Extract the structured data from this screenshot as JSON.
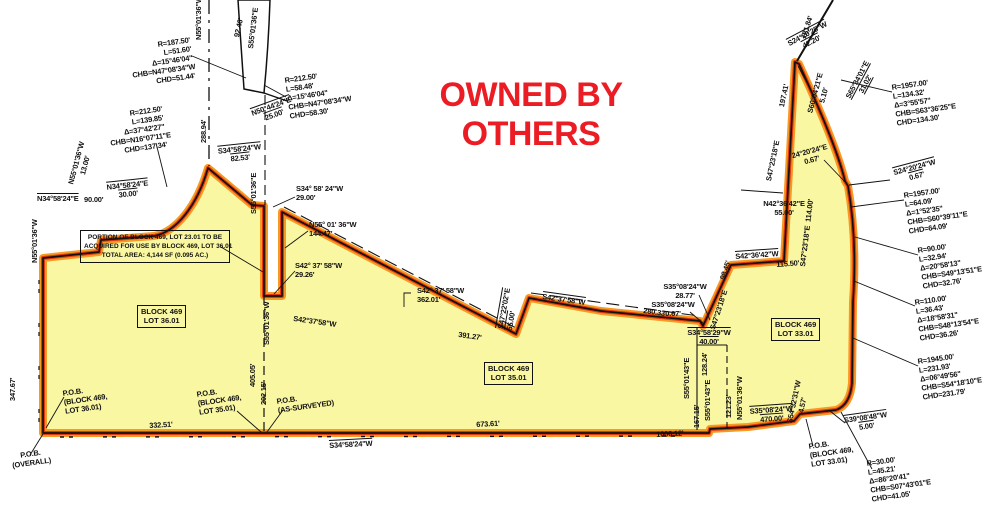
{
  "title": {
    "text": "OWNED BY OTHERS",
    "color": "#EC1C24",
    "x": 368,
    "y": 76,
    "w": 326
  },
  "colors": {
    "parcel_fill": "#FAF7A3",
    "boundary_glow": "#F59B23",
    "boundary_red": "#E23A0E",
    "line_black": "#111111"
  },
  "note_box": {
    "x": 80,
    "y": 230,
    "w": 142,
    "text": "PORTION OF BLOCK 469, LOT 23.01 TO BE\nACQUIRED FOR USE BY BLOCK 469, LOT 36.01\nTOTAL AREA: 4,144 SF (0.095 AC.)"
  },
  "lot_boxes": [
    {
      "n": "lot-label-36-01",
      "t": "BLOCK 469\nLOT 36.01",
      "x": 137,
      "y": 305
    },
    {
      "n": "lot-label-35-01",
      "t": "BLOCK 469\nLOT 35.01",
      "x": 484,
      "y": 362
    },
    {
      "n": "lot-label-33-01",
      "t": "BLOCK 469\nLOT 33.01",
      "x": 771,
      "y": 318
    }
  ],
  "labels": [
    {
      "n": "curve-data-1",
      "t": "R=187.50'\nL=51.60'\nΔ=15°46'04\"\nCHB=N47°08'34\"W\nCHD=51.44'",
      "x": 128,
      "y": 44,
      "r": -8,
      "c": "r",
      "w": 62
    },
    {
      "n": "curve-data-2",
      "t": "R=212.50'\nL=58.48'\nΔ=15°46'04\"\nCHB=N47°08'34\"W\nCHD=58.30'",
      "x": 284,
      "y": 76,
      "r": -8
    },
    {
      "n": "curve-data-3",
      "t": "R=212.50'\nL=139.85'\nΔ=37°42'27\"\nCHB=N16°07'11\"E\nCHD=137.34'",
      "x": 106,
      "y": 112,
      "r": -8,
      "c": "r",
      "w": 56
    },
    {
      "n": "curve-data-4",
      "t": "R=1957.00'\nL=134.32'\nΔ=3°55'57\"\nCHB=S63°36'25\"E\nCHD=134.30'",
      "x": 891,
      "y": 83,
      "r": -8
    },
    {
      "n": "curve-data-5",
      "t": "R=1957.00'\nL=64.09'\nΔ=1°52'35\"\nCHB=S60°39'11\"E\nCHD=64.09'",
      "x": 903,
      "y": 191,
      "r": -8
    },
    {
      "n": "curve-data-6",
      "t": "R=90.00'\nL=32.94'\nΔ=20°58'13\"\nCHB=S49°13'51\"E\nCHD=32.76'",
      "x": 917,
      "y": 246,
      "r": -8
    },
    {
      "n": "curve-data-7",
      "t": "R=110.00'\nL=36.43'\nΔ=18°58'31\"\nCHB=S48°13'54\"E\nCHD=36.26'",
      "x": 914,
      "y": 298,
      "r": -8
    },
    {
      "n": "curve-data-8",
      "t": "R=1945.00'\nL=231.93'\nΔ=06°49'56\"\nCHB=S54°18'10\"E\nCHD=231.79'",
      "x": 917,
      "y": 357,
      "r": -8
    },
    {
      "n": "curve-data-9",
      "t": "R=30.00'\nL=45.21'\nΔ=86°20'41\"\nCHB=S07°43'01\"E\nCHD=41.05'",
      "x": 866,
      "y": 459,
      "r": -8
    },
    {
      "t": "N50°44'24\"E\n25.00'",
      "x": 248,
      "y": 110,
      "r": -20,
      "c": "c ov",
      "w": 46
    },
    {
      "t": "S34°58'24\"W\n82.53'",
      "x": 215,
      "y": 147,
      "r": -6,
      "c": "c ov",
      "w": 48
    },
    {
      "t": "288.94'",
      "x": 199,
      "y": 143,
      "r": -90
    },
    {
      "t": "92.46'",
      "x": 232,
      "y": 36,
      "r": -77
    },
    {
      "t": "S55°01'36\"E",
      "x": 246,
      "y": 48,
      "r": -83
    },
    {
      "t": "N55°01'36\"W",
      "x": 194,
      "y": 40,
      "r": -90
    },
    {
      "t": "N55°01'36\"W\n13.00'",
      "x": 66,
      "y": 184,
      "r": -75,
      "c": "c",
      "w": 46
    },
    {
      "t": "N34°58'24\"E\n30.00'",
      "x": 104,
      "y": 183,
      "r": -6,
      "c": "c ov",
      "w": 46
    },
    {
      "t": "N34°58'24\"E",
      "x": 37,
      "y": 194,
      "c": "ov"
    },
    {
      "t": "90.00'",
      "x": 84,
      "y": 195
    },
    {
      "t": "N55°01'36\"W",
      "x": 30,
      "y": 263,
      "r": -90
    },
    {
      "t": "347.67'",
      "x": 8,
      "y": 401,
      "r": -90
    },
    {
      "t": "S55°01'36\"E",
      "x": 249,
      "y": 214,
      "r": -90
    },
    {
      "t": "S42°37'58\"W",
      "x": 294,
      "y": 314,
      "r": 8
    },
    {
      "t": "S42° 37' 58\"W\n362.01'",
      "x": 417,
      "y": 286
    },
    {
      "t": "391.27'",
      "x": 459,
      "y": 330,
      "r": 8
    },
    {
      "t": "S47°22'02\"E\n55.00'",
      "x": 496,
      "y": 328,
      "r": -80,
      "c": "ov"
    },
    {
      "t": "S42°37'58\"W",
      "x": 543,
      "y": 292,
      "r": 8,
      "c": "ov"
    },
    {
      "t": "280.33'",
      "x": 644,
      "y": 306,
      "r": 8
    },
    {
      "t": "S35°08'24\"W\n28.77'",
      "x": 662,
      "y": 282,
      "c": "c",
      "w": 46
    },
    {
      "t": "S35°08'24\"W\n0.67'",
      "x": 650,
      "y": 300,
      "c": "c",
      "w": 46
    },
    {
      "t": "98.45'",
      "x": 718,
      "y": 278,
      "r": -72
    },
    {
      "t": "S47°23'18\"E",
      "x": 708,
      "y": 328,
      "r": -72
    },
    {
      "t": "S42°36'42\"W",
      "x": 735,
      "y": 252,
      "r": -4,
      "c": "ov"
    },
    {
      "t": "115.50'",
      "x": 776,
      "y": 260,
      "r": -4
    },
    {
      "t": "N42°36'42\"E\n55.00'",
      "x": 763,
      "y": 199,
      "c": "c",
      "w": 42
    },
    {
      "t": "S47°23'18\"E  114.00'",
      "x": 798,
      "y": 266,
      "r": -83
    },
    {
      "t": "S47°23'18\"E",
      "x": 764,
      "y": 180,
      "r": -78
    },
    {
      "t": "24°20'24\"E\n0.67'",
      "x": 789,
      "y": 152,
      "r": -15,
      "c": "c",
      "w": 40
    },
    {
      "t": "S24°20'24\"W\n0.67'",
      "x": 890,
      "y": 169,
      "r": -15,
      "c": "c ov",
      "w": 48
    },
    {
      "t": "197.41'",
      "x": 777,
      "y": 106,
      "r": -78
    },
    {
      "t": "S60°04'21\"E\n5.10'",
      "x": 805,
      "y": 113,
      "r": -75,
      "c": "c",
      "w": 44
    },
    {
      "t": "S65°34'01\"E\n31.02'",
      "x": 843,
      "y": 97,
      "r": -62,
      "c": "c un",
      "w": 44
    },
    {
      "t": "S24°20'25\"W\n42.20'",
      "x": 784,
      "y": 41,
      "r": -28,
      "c": "c ov",
      "w": 48
    },
    {
      "t": "181.84'",
      "x": 799,
      "y": 37,
      "r": -72
    },
    {
      "t": "S39°08'48\"W\n5.00'",
      "x": 843,
      "y": 416,
      "r": -8,
      "c": "c ov",
      "w": 44
    },
    {
      "n": "pob-lot-33-01",
      "t": "P.O.B.\n(BLOCK 469,\nLOT 33.01)",
      "x": 808,
      "y": 442,
      "r": -8
    },
    {
      "t": "S54°32'31\"W\n4.57'",
      "x": 785,
      "y": 422,
      "r": -78,
      "c": "c",
      "w": 40
    },
    {
      "t": "S35°08'24\"W\n470.00'",
      "x": 748,
      "y": 407,
      "r": -4,
      "c": "c ov",
      "w": 46
    },
    {
      "t": "N55°01'36\"W",
      "x": 735,
      "y": 420,
      "r": -90
    },
    {
      "t": "121.23'",
      "x": 724,
      "y": 418,
      "r": -90
    },
    {
      "t": "S55°01'43\"E",
      "x": 682,
      "y": 399,
      "r": -90
    },
    {
      "t": "128.24'",
      "x": 700,
      "y": 376,
      "r": -90
    },
    {
      "t": "S55°01'43\"E",
      "x": 703,
      "y": 421,
      "r": -90
    },
    {
      "t": "167.15'",
      "x": 692,
      "y": 428,
      "r": -90
    },
    {
      "t": "S34°58'29\"W\n40.00'",
      "x": 686,
      "y": 328,
      "c": "c ov",
      "w": 46
    },
    {
      "n": "pob-lot-36-01",
      "t": "P.O.B.\n(BLOCK 469,\nLOT 36.01)",
      "x": 62,
      "y": 389,
      "r": -8
    },
    {
      "n": "pob-overall",
      "t": "P.O.B.\n(OVERALL)",
      "x": 4,
      "y": 453,
      "r": -8,
      "c": "c",
      "w": 52
    },
    {
      "n": "pob-lot-35-01",
      "t": "P.O.B.\n(BLOCK 469,\nLOT 35.01)",
      "x": 196,
      "y": 390,
      "r": -8
    },
    {
      "n": "pob-as-surveyed",
      "t": "P.O.B.\n(AS-SURVEYED)",
      "x": 276,
      "y": 397,
      "r": -8
    },
    {
      "t": "202.15'",
      "x": 259,
      "y": 405,
      "r": -90
    },
    {
      "t": "405.05'",
      "x": 248,
      "y": 387,
      "r": -90
    },
    {
      "t": "S55°01'36\"W",
      "x": 262,
      "y": 345,
      "r": -90
    },
    {
      "t": "332.51'",
      "x": 149,
      "y": 421,
      "r": -3
    },
    {
      "t": "673.61'",
      "x": 476,
      "y": 420,
      "r": -3
    },
    {
      "t": "1006.12'",
      "x": 656,
      "y": 430,
      "r": -3
    },
    {
      "t": "S34°58'24\"W",
      "x": 329,
      "y": 441,
      "r": -3,
      "c": "ov"
    },
    {
      "t": "S34° 58' 24\"W\n29.00'",
      "x": 296,
      "y": 184
    },
    {
      "t": "N55° 01' 36\"W\n144.47'",
      "x": 309,
      "y": 220
    },
    {
      "t": "S42° 37' 58\"W\n29.26'",
      "x": 295,
      "y": 261
    }
  ]
}
